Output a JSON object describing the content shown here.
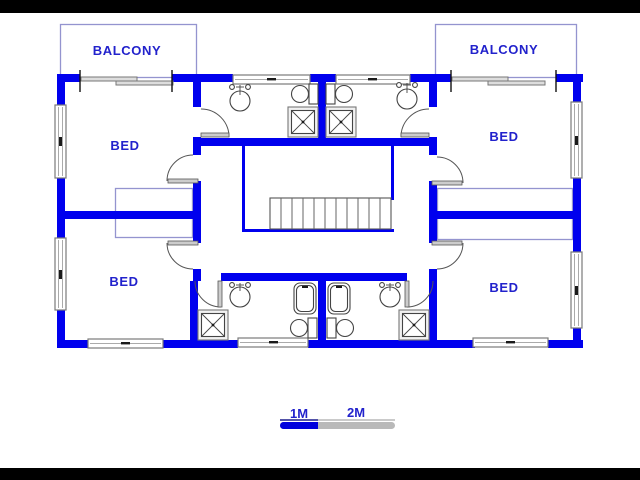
{
  "plan": {
    "rooms": {
      "balcony_left": "BALCONY",
      "balcony_right": "BALCONY",
      "bed_top_left": "BED",
      "bed_top_right": "BED",
      "bed_bottom_left": "BED",
      "bed_bottom_right": "BED"
    },
    "scale_bar": {
      "label_1m": "1M",
      "label_2m": "2M"
    },
    "colors": {
      "wall": "#0000ee",
      "label_text": "#2222cc",
      "pale_outline": "#9494cf",
      "fixture_line": "#555555",
      "window_line": "#7a7a7a",
      "scale_gray": "#b9b9b9",
      "scale_blue": "#0000dd",
      "letterbox": "#000000"
    }
  }
}
